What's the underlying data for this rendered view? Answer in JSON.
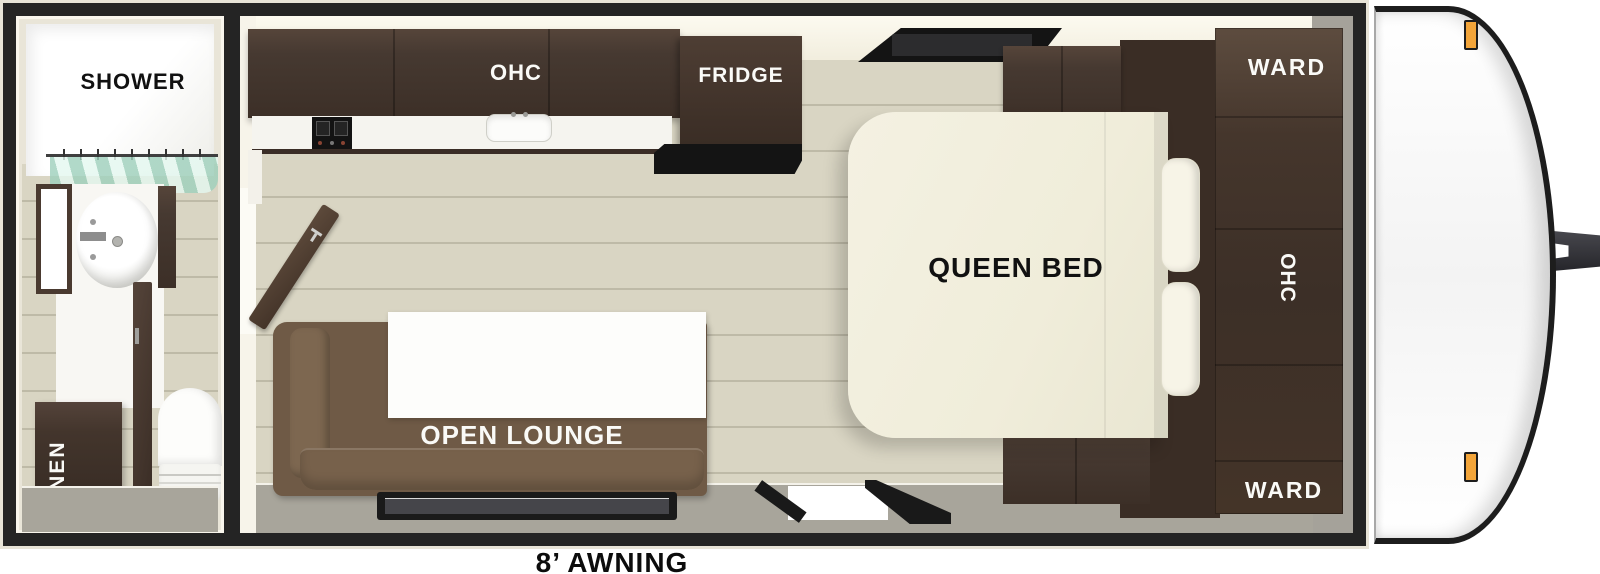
{
  "floorplan": {
    "labels": {
      "shower": "SHOWER",
      "linen": "LINEN",
      "kitchen_ohc": "OHC",
      "fridge": "FRIDGE",
      "open_lounge": "OPEN LOUNGE",
      "queen_bed": "QUEEN BED",
      "ward_top": "WARD",
      "bed_ohc": "OHC",
      "ward_bottom": "WARD",
      "awning": "8’ AWNING"
    },
    "colors": {
      "wall_frame": "#242424",
      "cream_wall": "#ebe7da",
      "wood_floor": "#d9d5c3",
      "walkway_gray": "#a8a59b",
      "cabinet_dark": "#43352c",
      "sofa_brown": "#6f5a46",
      "bed_cream": "#f1eede",
      "curtain_teal": "#b9ded2",
      "marker_orange": "#f3a53a"
    }
  }
}
